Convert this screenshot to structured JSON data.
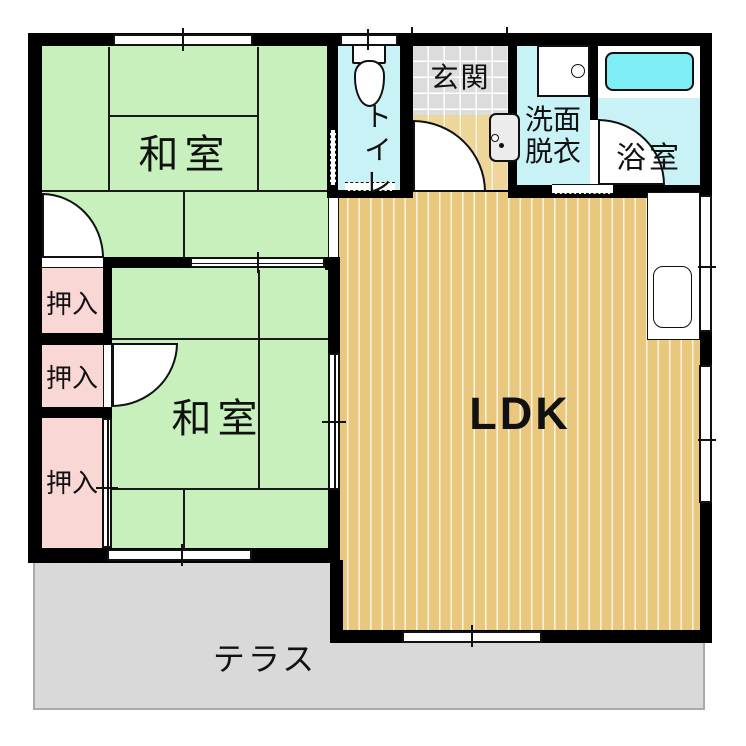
{
  "plan": {
    "rooms": {
      "washitsu_top": {
        "label": "和室"
      },
      "washitsu_bottom": {
        "label": "和室"
      },
      "ldk": {
        "label": "LDK"
      },
      "toilet": {
        "label": "トイレ"
      },
      "genkan": {
        "label": "玄関"
      },
      "washroom": {
        "label_line1": "洗面",
        "label_line2": "脱衣"
      },
      "bathroom": {
        "label": "浴室"
      },
      "closet1": {
        "label": "押入"
      },
      "closet2": {
        "label": "押入"
      },
      "closet3": {
        "label": "押入"
      },
      "terrace": {
        "label": "テラス"
      }
    },
    "colors": {
      "tatami_green": "#c7f0bd",
      "closet_pink": "#f9d7d5",
      "wet_room_cyan": "#c9f2f6",
      "bathtub_cyan": "#7deef5",
      "flooring_tan": "#e9c87e",
      "genkan_tile_gray": "#dcdcdc",
      "genkan_step_tan": "#eed69b",
      "terrace_gray": "#d9d9d9",
      "wall_black": "#000000"
    }
  }
}
